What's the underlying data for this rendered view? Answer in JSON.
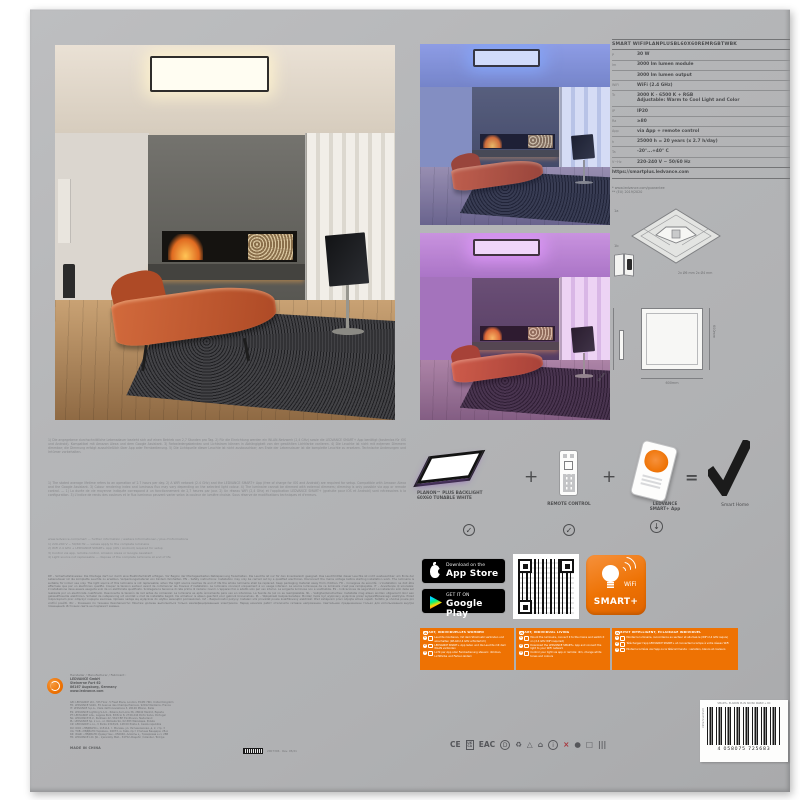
{
  "spec": {
    "title": "SMART WIFIPLANPLUSBL60X60REMRGBTWBK",
    "rows": [
      {
        "l": "P",
        "v": "30 W"
      },
      {
        "l": "lm",
        "v": "3000 lm lumen module"
      },
      {
        "l": "",
        "v": "3000 lm lumen output"
      },
      {
        "l": "WiFi",
        "v": "WiFi (2.4 GHz)"
      },
      {
        "l": "Tc",
        "v": "3000 K - 6500 K + RGB\nAdjustable: Warm to Cool Light and Color"
      },
      {
        "l": "IP",
        "v": "IP20"
      },
      {
        "l": "Ra",
        "v": "≥80"
      },
      {
        "l": "App",
        "v": "via App + remote control"
      },
      {
        "l": "h",
        "v": "25000 h = 20 years (x 2.7 h/day)"
      },
      {
        "l": "Ta",
        "v": "-20°...+40° C"
      },
      {
        "l": "V~Hz",
        "v": "220-240 V ~ 50/60 Hz"
      }
    ],
    "link": "https://smartplus.ledvance.com",
    "footnotes": "* www.ledvance.com/guarantee\n** (EU) 2019/2020"
  },
  "drawings": {
    "step1": "1a",
    "step2": "1b",
    "note": "2x Ø6 mm        2x Ø4 mm",
    "dim_right": "600mm",
    "dim_bottom": "600mm",
    "dim_side": "56 mm"
  },
  "legal": {
    "p1": "1) Die angegebene durchschnittliche Lebensdauer bezieht sich auf einen Betrieb von 2,7 Stunden pro Tag. 2) Für die Einrichtung werden ein WLAN-Netzwerk (2,4 GHz) sowie die LEDVANCE SMART+ App benötigt (kostenlos für iOS und Android). Kompatibel mit Amazon Alexa und dem Google Assistant. 3) Farbwiedergabeindex und Lichtstrom können in Abhängigkeit von der gewählten Lichtfarbe variieren. 4) Die Leuchte ist nicht mit externen Dimmern dimmbar; die Dimmung erfolgt ausschließlich über App oder Fernbedienung. 5) Die Lichtquelle dieser Leuchte ist nicht austauschbar; am Ende der Lebensdauer ist die komplette Leuchte zu ersetzen. Technische Änderungen und Irrtümer vorbehalten.",
    "p2": "1) The stated average lifetime refers to an operation of 2.7 hours per day. 2) A WiFi network (2.4 GHz) and the LEDVANCE SMART+ App (free of charge for iOS and Android) are required for setup. Compatible with Amazon Alexa and the Google Assistant. 3) Colour rendering index and luminous flux may vary depending on the selected light colour. 4) The luminaire cannot be dimmed with external dimmers; dimming is only possible via app or remote control. — 1) La durée de vie moyenne indiquée correspond à un fonctionnement de 2,7 heures par jour. 2) Un réseau WiFi (2,4 GHz) et l'application LEDVANCE SMART+ (gratuite pour iOS et Android) sont nécessaires à la configuration. 3) L'indice de rendu des couleurs et le flux lumineux peuvent varier selon la couleur de lumière choisie. Sous réserve de modifications techniques et d'erreurs.",
    "lines": "www.ledvance.com/smart — further information / weitere Informationen / plus d'informations\n1) 220-240 V ~ 50/60 Hz — values apply to the complete luminaire\n2) WiFi 2.4 GHz + LEDVANCE SMART+ App (iOS / Android) required for setup\n3) Control via app, remote control, Amazon Alexa or Google Assistant\n4) Light source not replaceable — dispose of the complete luminaire at end of life",
    "dense": "DE – Sicherheitshinweise: Die Montage darf nur durch eine Elektrofachkraft erfolgen. Vor Beginn der Montagearbeiten Netzspannung freischalten. Die Leuchte ist nur für den Innenbereich geeignet. Das Leuchtmittel dieser Leuchte ist nicht austauschbar; am Ende der Lebensdauer ist die komplette Leuchte zu ersetzen. Verpackungsmaterial von Kindern fernhalten. EN – Safety instructions: Installation may only be carried out by a qualified electrician. Disconnect the mains voltage before starting installation work. The luminaire is suitable for indoor use only. The light source of this luminaire is not replaceable; when the light source reaches its end of life the whole luminaire shall be replaced. Keep packaging material away from children. FR – Consignes de sécurité : L'installation ne doit être effectuée que par un électricien qualifié. Couper la tension secteur avant de commencer les travaux d'installation. Le luminaire convient uniquement à un usage intérieur. La source lumineuse de ce luminaire n'est pas remplaçable. IT – Avvertenze di sicurezza: L'installazione deve essere eseguita solo da un elettricista qualificato. Scollegare la tensione di rete prima di iniziare i lavori. L'apparecchio è adatto solo per uso interno. La sorgente luminosa non è sostituibile. ES – Indicaciones de seguridad: La instalación sólo debe ser realizada por un electricista cualificado. Desconecte la tensión de red antes de comenzar. La luminaria es apta únicamente para uso en interiores. La fuente de luz no es reemplazable. NL – Veiligheidsinstructies: Installatie mag alleen worden uitgevoerd door een gekwalificeerde elektricien. Schakel de netspanning uit voordat u met de installatie begint. De armatuur is alleen geschikt voor gebruik binnenshuis. PL – Wskazówki bezpieczeństwa: Montaż może być wykonany wyłącznie przez wykwalifikowanego elektryka. Przed rozpoczęciem prac odłączyć napięcie sieciowe. Oprawa nadaje się wyłącznie do użytku wewnątrz pomieszczeń. CZ – Bezpečnostní pokyny: Instalaci smí provádět pouze kvalifikovaný elektrikář. Před zahájením prací odpojte síťové napětí. Svítidlo je vhodné pouze pro vnitřní použití. RU – Указания по технике безопасности: Монтаж должен выполняться только квалифицированным электриком. Перед началом работ отключите сетевое напряжение. Светильник предназначен только для использования внутри помещений. Источник света не подлежит замене."
  },
  "combo": {
    "item1": "PLANON™ PLUS BACKLIGHT\n60X60 TUNABLE WHITE",
    "item2": "REMOTE CONTROL",
    "item3": "LEDVANCE\nSMART+ App",
    "plus": "+",
    "equals": "=",
    "check": "✓",
    "download": "↓",
    "result": "Smart Home"
  },
  "badges": {
    "appstore_top": "Download on the",
    "appstore_bottom": "App Store",
    "gplay_top": "GET IT ON",
    "gplay_bottom": "Google Play"
  },
  "smart_logo": {
    "wifi": "WiFi",
    "name": "SMART+"
  },
  "orange": {
    "s1": {
      "n": "1",
      "header": "SMART, INDIVIDUELLES WOHNEN",
      "b1": {
        "n": "1",
        "t": "Leuchte montieren, mit dem Stromnetz verbinden und einschalten (WLAN 2,4 GHz erforderlich)"
      },
      "b2": {
        "n": "2",
        "t": "LEDVANCE SMART+ App laden und die Leuchte mit dem WLAN verbinden"
      },
      "b3": {
        "n": "3",
        "t": "Licht per App oder Fernbedienung steuern: dimmen, Lichtfarbe und Farben ändern"
      }
    },
    "s2": {
      "n": "2",
      "header": "SMART, INDIVIDUAL LIVING",
      "b1": {
        "n": "1",
        "t": "Mount the luminaire, connect it to the mains and switch it on (2.4 GHz WiFi required)"
      },
      "b2": {
        "n": "2",
        "t": "Download the LEDVANCE SMART+ App and connect the light to your WiFi network"
      },
      "b3": {
        "n": "3",
        "t": "Control your light via app or remote: dim, change white tones and colours"
      }
    },
    "s3": {
      "n": "3",
      "header": "HABITAT INTELLIGENT, ÉCLAIRAGE INDIVIDUEL",
      "b1": {
        "n": "1",
        "t": "Montez le luminaire, raccordez-le au secteur et allumez-le (WiFi 2,4 GHz requis)"
      },
      "b2": {
        "n": "2",
        "t": "Téléchargez l'app LEDVANCE SMART+ et connectez la lampe à votre réseau WiFi"
      },
      "b3": {
        "n": "3",
        "t": "Pilotez la lumière via l'app ou la télécommande : variation, blancs et couleurs"
      }
    }
  },
  "footer": {
    "maker_head": "Hersteller / Manufacturer / Fabricant :",
    "company": "LEDVANCE GmbH\nSteinerne Furt 62\n86167 Augsburg, Germany\nwww.ledvance.com",
    "distributors": "GB: LEDVANCE Ltd., 5th Floor, 5 Fleet Place, London, EC4M 7RD, United Kingdom\nFR: LEDVANCE SASU, 55 Avenue des Champs Pierreux, 92012 Nanterre, France\nIT: LEDVANCE S.p.A., Viale dell'Innovazione 3, 20126 Milano, Italia\nES: LEDVANCE Lighting S.A.U., Ribera del Loira 36, 28042 Madrid, España\nPT: LEDVANCE Lda., Lagoas Park, Edifício 8, 2740-244 Porto Salvo, Portugal\nNL: LEDVANCE B.V., Parklaan 42, 5613 BH Eindhoven, Nederland\nPL: LEDVANCE Sp. z o.o., ul. Wołoska 9A, 02-583 Warszawa, Polska\nCZ: LEDVANCE s.r.o., V Parku 2343/24, 148 00 Praha 4, Česká republika\nRU: ООО «ЛЕДВАНС», 115114, г. Москва, ул. Летниковская, д. 2, стр. 3\nUA: ТОВ «ЛЕДВАНС Україна», 04073, м. Київ, пр-т Степана Бандери, 28-А\nKZ: ЖШС «ЛЕДВАНС Қазақстан», 050040, Алматы қ., Тимирязев к-сі, 28В\nTR: LEDVANCE Ltd. Şti., İçerenköy Mah., 34752 Ataşehir / İstanbul, Türkiye",
    "made_in": "MADE IN CHINA",
    "chip": "2007306 · Rev. 05/21",
    "certs": [
      "CE",
      "UK\nCA",
      "EAC",
      "D",
      "♻",
      "△",
      "⌂",
      "i",
      "×",
      "●",
      "□",
      "|||"
    ],
    "barcode_digits": "4 058075 725683",
    "barcode_side": "4058075725683",
    "sticker_top": "SMART+ PLANON PLUS 60X60 RGBW + RC"
  }
}
